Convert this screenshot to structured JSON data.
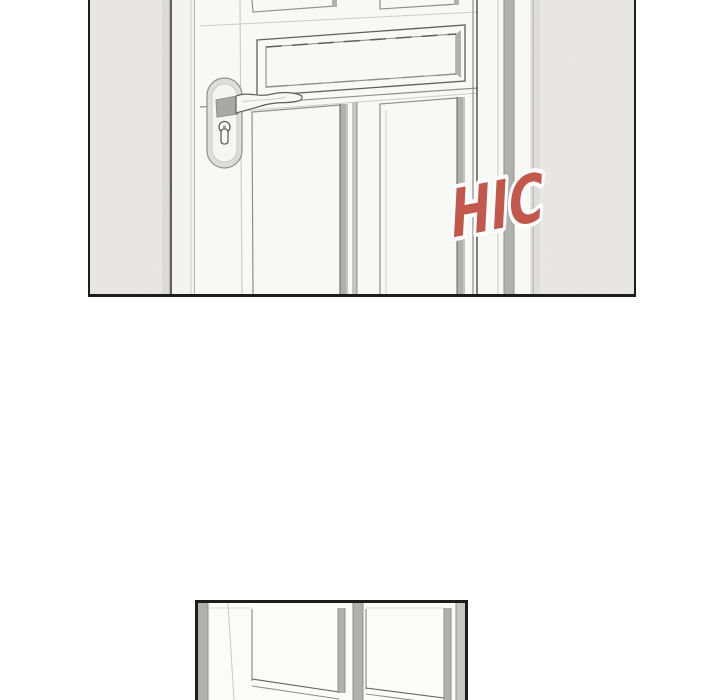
{
  "colors": {
    "paper": "#ffffff",
    "ink": "#1d1d1b",
    "wall": "#ebeae7",
    "door": "#f8f8f6",
    "frame": "#f3f3f1",
    "plate": "#dddddb",
    "shadow": "#b0b0ae",
    "shadow-light": "#c6c6c4",
    "line-dark": "#5f5f5d",
    "line": "#8f8f8d",
    "line-faint": "#cccccb",
    "sfx": "#c4574b",
    "sfx-outline": "#ffffff"
  },
  "panels": {
    "top": {
      "sfx": {
        "text": "HIC"
      }
    },
    "bottom": {}
  }
}
